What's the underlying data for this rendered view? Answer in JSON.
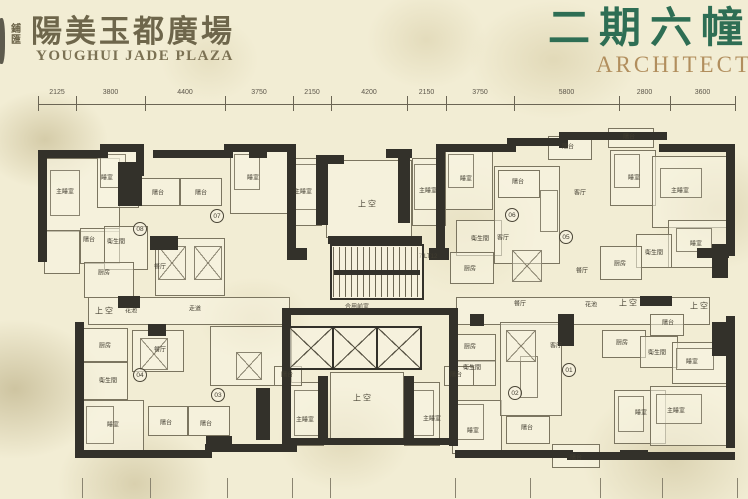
{
  "header": {
    "brand_char_1": "鋪",
    "brand_char_2": "匯",
    "title_cn": "陽美玉都廣場",
    "title_en": "YOUGHUI JADE PLAZA",
    "phase_cn": "二期六幢",
    "phase_en": "ARCHITECT"
  },
  "colors": {
    "paper": "#f2edd4",
    "wall": "#33312a",
    "line": "#7b7560",
    "title": "#6e664b",
    "phase_green": "#2e6e54",
    "phase_gold": "#b18e5d"
  },
  "dimensions": {
    "top_boundaries": [
      38,
      76,
      145,
      225,
      293,
      331,
      407,
      446,
      514,
      619,
      670,
      735
    ],
    "top_labels": [
      "2125",
      "3800",
      "4400",
      "3750",
      "2150",
      "4200",
      "2150",
      "3750",
      "5800",
      "2800",
      "3600"
    ],
    "bottom_tick_x": [
      82,
      150,
      227,
      292,
      330,
      455,
      530,
      600,
      662,
      737
    ]
  },
  "plan": {
    "walls": [
      [
        38,
        150,
        70,
        8
      ],
      [
        38,
        150,
        9,
        112
      ],
      [
        100,
        144,
        44,
        8
      ],
      [
        136,
        144,
        8,
        32
      ],
      [
        118,
        162,
        24,
        44
      ],
      [
        153,
        150,
        80,
        8
      ],
      [
        224,
        144,
        70,
        8
      ],
      [
        287,
        144,
        9,
        112
      ],
      [
        287,
        248,
        20,
        12
      ],
      [
        316,
        155,
        12,
        70
      ],
      [
        316,
        155,
        28,
        9
      ],
      [
        398,
        149,
        12,
        74
      ],
      [
        386,
        149,
        26,
        9
      ],
      [
        436,
        144,
        9,
        112
      ],
      [
        429,
        248,
        20,
        12
      ],
      [
        444,
        144,
        72,
        8
      ],
      [
        507,
        138,
        60,
        8
      ],
      [
        559,
        132,
        9,
        16
      ],
      [
        559,
        132,
        108,
        8
      ],
      [
        659,
        144,
        70,
        8
      ],
      [
        726,
        144,
        9,
        112
      ],
      [
        712,
        244,
        16,
        34
      ],
      [
        726,
        316,
        9,
        132
      ],
      [
        712,
        322,
        16,
        34
      ],
      [
        75,
        322,
        9,
        132
      ],
      [
        75,
        450,
        137,
        8
      ],
      [
        205,
        444,
        92,
        8
      ],
      [
        455,
        450,
        118,
        8
      ],
      [
        567,
        452,
        168,
        8
      ],
      [
        282,
        308,
        176,
        7
      ],
      [
        282,
        308,
        9,
        138
      ],
      [
        449,
        308,
        9,
        138
      ],
      [
        282,
        438,
        176,
        7
      ],
      [
        318,
        376,
        10,
        62
      ],
      [
        404,
        376,
        10,
        62
      ],
      [
        328,
        236,
        94,
        8
      ],
      [
        150,
        236,
        28,
        14
      ],
      [
        249,
        144,
        18,
        14
      ],
      [
        118,
        296,
        22,
        12
      ],
      [
        148,
        324,
        18,
        12
      ],
      [
        256,
        388,
        14,
        52
      ],
      [
        558,
        314,
        16,
        32
      ],
      [
        640,
        296,
        32,
        10
      ],
      [
        697,
        248,
        32,
        10
      ],
      [
        206,
        436,
        26,
        12
      ],
      [
        470,
        314,
        14,
        12
      ],
      [
        620,
        450,
        28,
        10
      ]
    ],
    "rooms": [
      [
        44,
        158,
        74,
        72
      ],
      [
        97,
        150,
        40,
        56
      ],
      [
        44,
        230,
        34,
        42
      ],
      [
        80,
        228,
        38,
        34
      ],
      [
        104,
        226,
        42,
        42
      ],
      [
        84,
        262,
        48,
        34
      ],
      [
        140,
        178,
        38,
        26
      ],
      [
        180,
        178,
        40,
        26
      ],
      [
        155,
        238,
        68,
        56
      ],
      [
        230,
        150,
        58,
        62
      ],
      [
        290,
        158,
        30,
        66
      ],
      [
        412,
        158,
        32,
        66
      ],
      [
        326,
        160,
        84,
        76
      ],
      [
        445,
        150,
        46,
        58
      ],
      [
        456,
        220,
        44,
        34
      ],
      [
        450,
        252,
        42,
        30
      ],
      [
        494,
        166,
        64,
        96
      ],
      [
        610,
        150,
        44,
        54
      ],
      [
        652,
        156,
        74,
        70
      ],
      [
        668,
        220,
        58,
        46
      ],
      [
        636,
        234,
        34,
        32
      ],
      [
        600,
        246,
        40,
        32
      ],
      [
        548,
        136,
        42,
        22
      ],
      [
        498,
        170,
        40,
        26
      ],
      [
        608,
        128,
        44,
        18
      ],
      [
        88,
        297,
        200,
        26
      ],
      [
        456,
        297,
        252,
        26
      ],
      [
        82,
        328,
        44,
        32
      ],
      [
        82,
        362,
        44,
        36
      ],
      [
        132,
        330,
        50,
        40
      ],
      [
        80,
        400,
        62,
        54
      ],
      [
        148,
        406,
        38,
        28
      ],
      [
        188,
        406,
        40,
        28
      ],
      [
        210,
        326,
        80,
        58
      ],
      [
        290,
        382,
        32,
        62
      ],
      [
        404,
        382,
        34,
        62
      ],
      [
        330,
        372,
        72,
        70
      ],
      [
        452,
        400,
        48,
        52
      ],
      [
        454,
        334,
        40,
        26
      ],
      [
        454,
        360,
        40,
        24
      ],
      [
        500,
        322,
        60,
        92
      ],
      [
        602,
        330,
        42,
        26
      ],
      [
        640,
        336,
        36,
        30
      ],
      [
        672,
        342,
        54,
        40
      ],
      [
        614,
        390,
        50,
        52
      ],
      [
        650,
        386,
        78,
        58
      ],
      [
        506,
        416,
        42,
        26
      ],
      [
        552,
        444,
        46,
        22
      ],
      [
        650,
        314,
        32,
        20
      ],
      [
        274,
        366,
        26,
        18
      ],
      [
        444,
        366,
        28,
        18
      ]
    ],
    "beds": [
      [
        50,
        170,
        28,
        44
      ],
      [
        100,
        154,
        24,
        32
      ],
      [
        234,
        154,
        24,
        34
      ],
      [
        294,
        164,
        24,
        44
      ],
      [
        414,
        164,
        24,
        44
      ],
      [
        448,
        154,
        24,
        32
      ],
      [
        614,
        154,
        24,
        32
      ],
      [
        660,
        168,
        40,
        28
      ],
      [
        676,
        228,
        34,
        22
      ],
      [
        86,
        406,
        26,
        36
      ],
      [
        294,
        390,
        24,
        44
      ],
      [
        408,
        390,
        24,
        44
      ],
      [
        456,
        404,
        26,
        34
      ],
      [
        618,
        396,
        24,
        34
      ],
      [
        656,
        394,
        44,
        28
      ],
      [
        676,
        348,
        36,
        20
      ],
      [
        540,
        190,
        16,
        40
      ],
      [
        520,
        356,
        16,
        40
      ]
    ],
    "tables": [
      [
        158,
        246,
        26,
        32
      ],
      [
        194,
        246,
        26,
        32
      ],
      [
        512,
        250,
        28,
        30
      ],
      [
        140,
        338,
        26,
        30
      ],
      [
        506,
        330,
        28,
        30
      ],
      [
        236,
        352,
        24,
        26
      ]
    ],
    "labels": [
      [
        "主睡室",
        65,
        191
      ],
      [
        "睡室",
        107,
        177
      ],
      [
        "陽台",
        89,
        239
      ],
      [
        "衛生間",
        116,
        241
      ],
      [
        "厨房",
        104,
        272
      ],
      [
        "餐厅",
        160,
        266
      ],
      [
        "陽台",
        158,
        192
      ],
      [
        "陽台",
        201,
        192
      ],
      [
        "睡室",
        253,
        177
      ],
      [
        "主睡室",
        303,
        191
      ],
      [
        "主睡室",
        428,
        190
      ],
      [
        "睡室",
        466,
        178
      ],
      [
        "衛生間",
        480,
        238
      ],
      [
        "厨房",
        470,
        268
      ],
      [
        "客厅",
        503,
        237
      ],
      [
        "陽台",
        518,
        181
      ],
      [
        "陽台",
        568,
        146
      ],
      [
        "陽台",
        629,
        136
      ],
      [
        "客厅",
        580,
        192
      ],
      [
        "睡室",
        634,
        177
      ],
      [
        "主睡室",
        680,
        190
      ],
      [
        "睡室",
        696,
        243
      ],
      [
        "衛生間",
        654,
        252
      ],
      [
        "厨房",
        620,
        263
      ],
      [
        "餐厅",
        582,
        270
      ],
      [
        "花池",
        131,
        310
      ],
      [
        "走道",
        195,
        308
      ],
      [
        "合用前室",
        357,
        306
      ],
      [
        "餐厅",
        520,
        303
      ],
      [
        "花池",
        591,
        304
      ],
      [
        "厨房",
        105,
        345
      ],
      [
        "衛生間",
        108,
        380
      ],
      [
        "餐厅",
        160,
        349
      ],
      [
        "睡室",
        113,
        424
      ],
      [
        "陽台",
        166,
        422
      ],
      [
        "陽台",
        206,
        423
      ],
      [
        "陽台",
        287,
        374
      ],
      [
        "主睡室",
        305,
        419
      ],
      [
        "主睡室",
        432,
        418
      ],
      [
        "陽台",
        456,
        374
      ],
      [
        "睡室",
        473,
        430
      ],
      [
        "厨房",
        470,
        346
      ],
      [
        "衛生間",
        472,
        367
      ],
      [
        "客厅",
        556,
        345
      ],
      [
        "厨房",
        622,
        342
      ],
      [
        "衛生間",
        657,
        352
      ],
      [
        "睡室",
        692,
        361
      ],
      [
        "睡室",
        641,
        412
      ],
      [
        "主睡室",
        676,
        410
      ],
      [
        "陽台",
        527,
        427
      ],
      [
        "陽台",
        576,
        457
      ],
      [
        "陽台",
        668,
        322
      ],
      [
        "7-LT12",
        428,
        257
      ]
    ],
    "void_labels": [
      [
        "上空",
        368,
        204
      ],
      [
        "上空",
        105,
        311
      ],
      [
        "上空",
        629,
        303
      ],
      [
        "上空",
        700,
        306
      ],
      [
        "上空",
        363,
        398
      ]
    ],
    "badges": [
      [
        "08",
        140,
        229
      ],
      [
        "07",
        217,
        216
      ],
      [
        "06",
        512,
        215
      ],
      [
        "05",
        566,
        237
      ],
      [
        "04",
        140,
        375
      ],
      [
        "03",
        218,
        395
      ],
      [
        "02",
        515,
        393
      ],
      [
        "01",
        569,
        370
      ]
    ],
    "stair": {
      "x": 330,
      "y": 244,
      "w": 90,
      "h": 52
    },
    "elevators": {
      "x": 288,
      "y": 326,
      "w": 130,
      "h": 40,
      "count": 3
    }
  }
}
